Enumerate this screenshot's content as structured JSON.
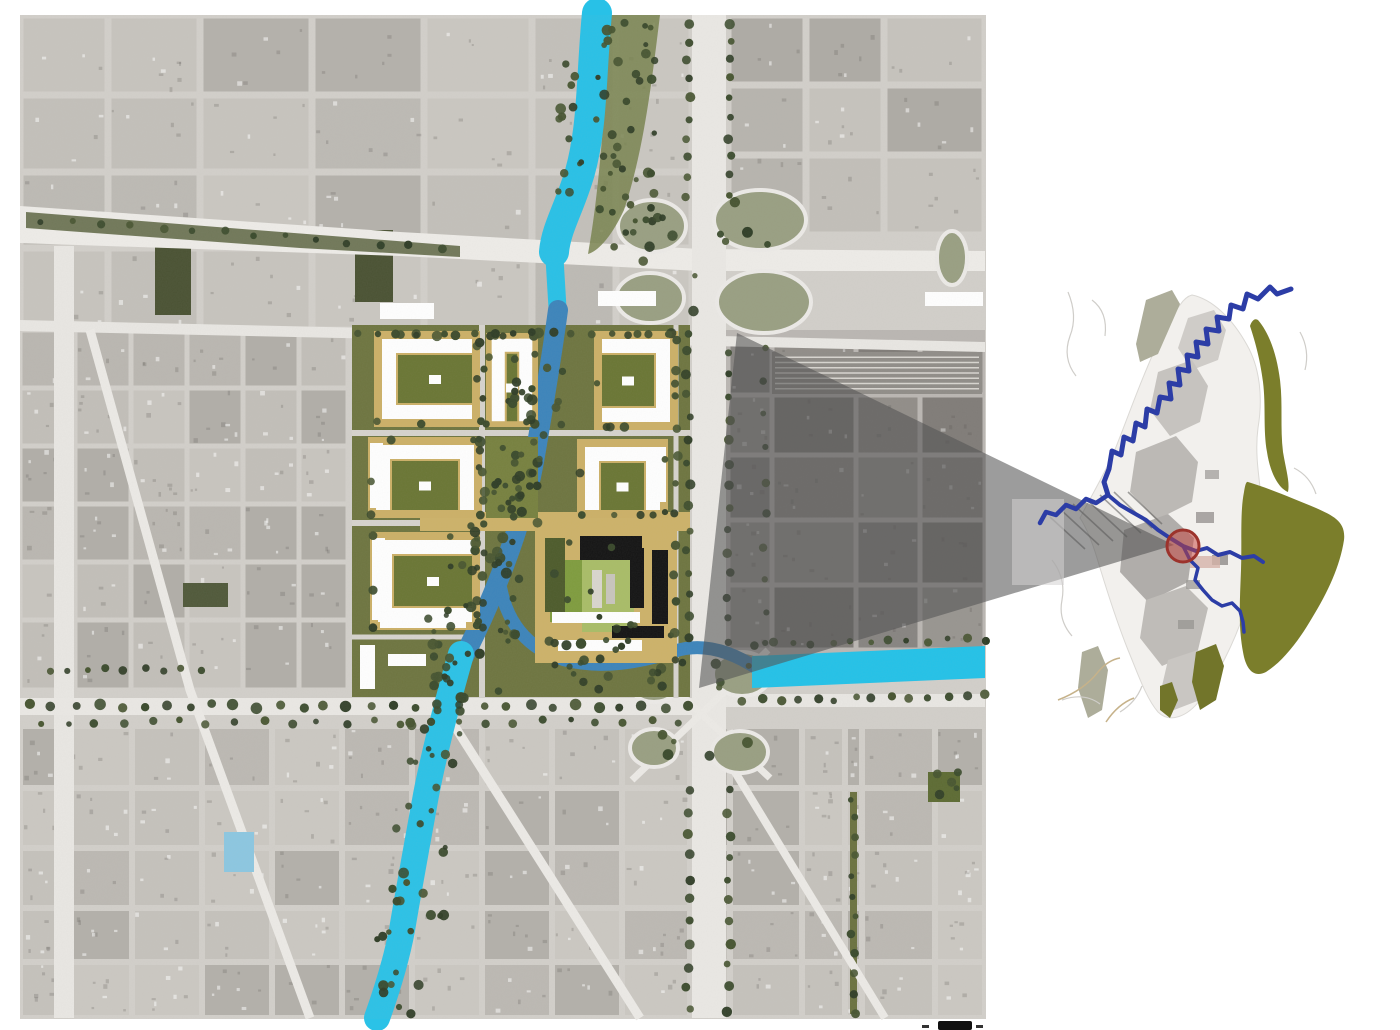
{
  "seed": 7,
  "palette": {
    "page_bg": "#ffffff",
    "aerial_base": "#d2cfca",
    "road": "#eceae6",
    "river_cyan": "#28c1e7",
    "river_steel": "#3c84bb",
    "plan_tan": "#ccb067",
    "plan_court_green": "#6a7634",
    "plan_olive": "#6e7540",
    "tree_greens": [
      "#2f3d26",
      "#3a4a2c",
      "#465430"
    ],
    "wedge_gray": "rgba(85,85,85,0.58)",
    "inset_land": "#f2f0ed",
    "inset_olive": "#7b7e2b",
    "inset_river_blue": "#2c3da6",
    "marker_red_fill": "rgba(197,64,58,0.5)",
    "marker_red_stroke": "#9c332c"
  },
  "main_map": {
    "frame": {
      "x": 20,
      "y": 15,
      "w": 966,
      "h": 1004,
      "fill": "#d2cfca"
    },
    "regions": [
      {
        "cols": [
          20,
          108,
          200,
          312,
          424,
          532,
          616,
          692
        ],
        "rows": [
          15,
          95,
          172,
          248,
          330
        ],
        "roadW": 7,
        "shades": [
          "#c7c4be",
          "#bdbab4",
          "#c3c0ba",
          "#b4b1ab",
          "#cac7c1"
        ],
        "speck": true
      },
      {
        "cols": [
          728,
          806,
          884,
          985
        ],
        "rows": [
          15,
          85,
          155,
          235
        ],
        "roadW": 7,
        "shades": [
          "#c2bfb9",
          "#b7b4ae",
          "#aeaba5",
          "#c6c3bd"
        ],
        "speck": true
      },
      {
        "cols": [
          728,
          772,
          856,
          920,
          985
        ],
        "rows": [
          340,
          395,
          455,
          520,
          585,
          650
        ],
        "roadW": 5,
        "shades": [
          "#a19e98",
          "#969390",
          "#8d8a85",
          "#aaa7a1"
        ],
        "speck": true
      },
      {
        "cols": [
          20,
          75,
          131,
          187,
          243,
          299,
          348
        ],
        "rows": [
          330,
          388,
          446,
          504,
          562,
          620,
          690
        ],
        "roadW": 5,
        "shades": [
          "#c2bfb9",
          "#bab7b1",
          "#b1aea8",
          "#c8c5bf"
        ],
        "speck": true
      },
      {
        "cols": [
          20,
          62,
          132,
          202,
          272,
          342,
          412,
          482,
          552,
          622,
          690,
          730,
          802,
          845,
          862,
          935,
          985
        ],
        "rows": [
          726,
          788,
          848,
          908,
          962,
          1018
        ],
        "roadW": 6,
        "shades": [
          "#c5c2bc",
          "#bcb9b3",
          "#b3b0aa",
          "#cbc8c2"
        ],
        "speck": true
      }
    ],
    "dark_blocks": [
      [
        155,
        245,
        36,
        70,
        "#4a5233"
      ],
      [
        355,
        230,
        38,
        72,
        "#4a5233"
      ],
      [
        183,
        583,
        45,
        24,
        "#50593a"
      ],
      [
        928,
        772,
        32,
        30,
        "#5d6b33"
      ]
    ],
    "rail": {
      "x": 772,
      "y": 352,
      "w": 210,
      "h": 42,
      "fill": "#908d88",
      "lines": 7,
      "lc": "#d8d5d0"
    },
    "shade": {
      "x": 698,
      "y": 330,
      "w": 287,
      "h": 330,
      "fill": "#3c3a37",
      "op": 0.16
    },
    "highways": [
      {
        "d": "M20,206 L400,232 L700,249 L985,251 L985,271 L700,271 L400,256 L20,243 Z",
        "fill": "#eeece8"
      },
      {
        "d": "M26,212 L460,246 L460,257 L300,248 L26,228 Z",
        "fill": "#5a6440",
        "op": 0.85
      },
      {
        "d": "M20,320 L985,342 L985,352 L20,331 Z",
        "fill": "#e9e7e3"
      },
      {
        "d": "M692,15 h34 v1003 h-34 Z",
        "fill": "#eae8e4"
      },
      {
        "d": "M54,246 h20 v772 h-20 Z",
        "fill": "#e9e7e3"
      },
      {
        "d": "M20,698 h672 v17 h-672 Z",
        "fill": "#eae8e4"
      },
      {
        "d": "M726,694 h259 v13 h-259 Z",
        "fill": "#e9e7e3"
      },
      {
        "d": "M850,792 h7 v222 h-7 Z",
        "fill": "#6b7240"
      }
    ],
    "road_strokes": {
      "color": "#eceae6",
      "items": [
        {
          "d": "M90,330 L190,690 L310,1018",
          "w": 9
        },
        {
          "d": "M438,700 L640,1018",
          "w": 9
        },
        {
          "d": "M735,772 L885,1018",
          "w": 8
        },
        {
          "d": "M635,652 L770,778",
          "w": 7
        },
        {
          "d": "M768,650 L632,780",
          "w": 7
        }
      ]
    },
    "loops": {
      "fill": "#999f82",
      "stroke": "#eceae7",
      "items": [
        [
          652,
          226,
          34,
          26
        ],
        [
          760,
          220,
          46,
          30
        ],
        [
          650,
          298,
          34,
          25
        ],
        [
          764,
          302,
          47,
          31
        ],
        [
          952,
          258,
          15,
          27
        ],
        [
          654,
          682,
          25,
          20
        ],
        [
          742,
          674,
          29,
          22
        ],
        [
          654,
          748,
          24,
          19
        ],
        [
          740,
          752,
          28,
          21
        ]
      ]
    },
    "bank": {
      "d": "M608,15 L660,15 C652,80 644,150 624,210 C610,240 596,252 588,254 C596,210 602,150 606,80 Z",
      "fill": "#78824e",
      "op": 0.85
    },
    "rivers": [
      {
        "d": "M597,13 C591,75 593,125 580,172 C570,207 556,228 554,252",
        "c": "#28c1e7",
        "w": 30
      },
      {
        "d": "M554,250 L558,316",
        "c": "#28c1e7",
        "w": 18
      },
      {
        "d": "M558,310 C551,362 544,402 536,450 C529,494 517,532 504,566 C494,592 480,626 463,658",
        "c": "#3c84bb",
        "w": 20
      },
      {
        "d": "M499,578 C505,625 530,650 565,660 C600,669 640,663 675,651 C707,641 737,655 758,669",
        "c": "#3c84bb",
        "w": 13
      },
      {
        "d": "M461,654 C448,700 435,748 426,795 C417,845 409,888 402,930 C396,962 387,990 377,1018",
        "c": "#2bc2e7",
        "w": 26
      }
    ],
    "canal": {
      "d": "M752,656 L985,646 L985,678 L752,688 Z",
      "fill": "#23c2e8"
    },
    "pond": {
      "x": 224,
      "y": 832,
      "w": 30,
      "h": 40,
      "fill": "#8cc7e1"
    },
    "plan": {
      "base": {
        "x": 352,
        "y": 325,
        "w": 338,
        "h": 372,
        "fill": "#6e7540"
      },
      "street_color": "#d6d3cd",
      "streets": [
        {
          "d": "M352,433 H690",
          "w": 6
        },
        {
          "d": "M352,523 H690",
          "w": 6
        },
        {
          "d": "M482,325 V697",
          "w": 6
        },
        {
          "d": "M676,325 V697",
          "w": 5
        },
        {
          "d": "M352,637 H480",
          "w": 5
        }
      ],
      "tan_band": {
        "d": "M420,512 H690 V531 H420 Z",
        "fill": "#cdb269"
      },
      "tan": "#ccb067",
      "court": "#6a7634",
      "white": "#ffffff",
      "blocks": [
        {
          "x": 374,
          "y": 331,
          "w": 106,
          "h": 96,
          "u": "E"
        },
        {
          "x": 486,
          "y": 333,
          "w": 52,
          "h": 94,
          "u": "S"
        },
        {
          "x": 594,
          "y": 331,
          "w": 84,
          "h": 99,
          "u": "W"
        },
        {
          "x": 368,
          "y": 437,
          "w": 114,
          "h": 81,
          "u": "S",
          "slabL": true
        },
        {
          "x": 486,
          "y": 437,
          "w": 52,
          "h": 81,
          "green": true
        },
        {
          "x": 577,
          "y": 439,
          "w": 91,
          "h": 79,
          "u": "S",
          "slabR": true
        },
        {
          "x": 370,
          "y": 532,
          "w": 110,
          "h": 98,
          "u": "E",
          "slabL": true,
          "slabB": true
        }
      ],
      "special": [
        [
          535,
          528,
          142,
          135,
          "#cdb269"
        ],
        [
          550,
          560,
          32,
          62,
          "#7f9c3e"
        ],
        [
          582,
          558,
          52,
          74,
          "#a9bd67"
        ],
        [
          545,
          538,
          20,
          74,
          "#4d5b2b"
        ],
        [
          580,
          536,
          62,
          24,
          "#141414"
        ],
        [
          630,
          548,
          14,
          60,
          "#141414"
        ],
        [
          652,
          550,
          16,
          74,
          "#141414"
        ],
        [
          612,
          626,
          52,
          12,
          "#141414"
        ],
        [
          552,
          612,
          88,
          11,
          "#ffffff"
        ],
        [
          592,
          570,
          10,
          38,
          "#d9d6ce"
        ],
        [
          606,
          574,
          9,
          30,
          "#c8c5bd"
        ],
        [
          558,
          640,
          84,
          11,
          "#ffffff"
        ]
      ],
      "slabs": [
        [
          380,
          303,
          54,
          16
        ],
        [
          598,
          291,
          58,
          15
        ],
        [
          925,
          292,
          58,
          14
        ],
        [
          360,
          645,
          15,
          44
        ],
        [
          388,
          654,
          38,
          12
        ]
      ]
    },
    "tree_rows": [
      [
        688,
        22,
        688,
        195,
        10,
        4
      ],
      [
        729,
        22,
        729,
        195,
        10,
        4
      ],
      [
        688,
        352,
        688,
        640,
        14,
        4
      ],
      [
        729,
        352,
        729,
        640,
        14,
        4
      ],
      [
        688,
        790,
        688,
        1010,
        11,
        4
      ],
      [
        729,
        790,
        729,
        1010,
        11,
        4
      ],
      [
        30,
        706,
        688,
        706,
        30,
        4.5
      ],
      [
        40,
        722,
        680,
        722,
        24,
        3.5
      ],
      [
        755,
        644,
        985,
        640,
        13,
        3.5
      ],
      [
        742,
        700,
        985,
        696,
        14,
        4
      ],
      [
        853,
        798,
        853,
        1012,
        12,
        3.5
      ],
      [
        50,
        670,
        200,
        670,
        9,
        3.5
      ],
      [
        360,
        334,
        688,
        334,
        18,
        4
      ],
      [
        482,
        345,
        482,
        628,
        12,
        4
      ],
      [
        676,
        340,
        676,
        660,
        12,
        4
      ],
      [
        765,
        350,
        765,
        645,
        10,
        3.5
      ],
      [
        40,
        220,
        440,
        248,
        14,
        3.5
      ]
    ],
    "tree_patches": [
      [
        596,
        20,
        60,
        230,
        44
      ],
      [
        558,
        30,
        24,
        215,
        13
      ],
      [
        505,
        332,
        60,
        96,
        20
      ],
      [
        480,
        430,
        64,
        100,
        22
      ],
      [
        450,
        525,
        70,
        108,
        24
      ],
      [
        418,
        605,
        100,
        88,
        26
      ],
      [
        540,
        640,
        140,
        52,
        22
      ],
      [
        404,
        690,
        62,
        118,
        16
      ],
      [
        392,
        808,
        54,
        118,
        14
      ],
      [
        376,
        928,
        48,
        86,
        11
      ],
      [
        618,
        196,
        180,
        140,
        12
      ],
      [
        628,
        660,
        150,
        108,
        10
      ],
      [
        928,
        772,
        32,
        30,
        5
      ]
    ],
    "icon": {
      "x": 938,
      "y": 1021,
      "w": 34,
      "h": 9,
      "fill": "#101010",
      "ticks": [
        [
          922,
          1025,
          7,
          3
        ],
        [
          976,
          1025,
          7,
          3
        ]
      ]
    }
  },
  "overlay": {
    "wedge": {
      "points": "737,333 1174,545 699,688",
      "fill": "rgba(85,85,85,0.58)"
    },
    "panel": {
      "x": 1012,
      "y": 499,
      "w": 52,
      "h": 86,
      "fill": "rgba(212,209,209,0.55)"
    }
  },
  "inset_map": {
    "land": {
      "d": "M1192,295 C1212,299 1232,318 1247,345 C1260,368 1263,398 1258,428 C1254,458 1261,486 1263,515 C1265,545 1255,578 1245,610 C1234,644 1217,676 1200,700 C1188,716 1170,724 1158,712 C1146,698 1138,674 1128,650 C1116,620 1106,588 1097,558 C1090,535 1084,524 1080,518 C1090,498 1103,477 1114,452 C1125,425 1135,396 1147,368 C1158,341 1170,318 1180,305 C1184,299 1188,296 1192,295 Z",
      "fill": "#f2f0ed",
      "stroke": "#dbd9d5"
    },
    "patches": [
      {
        "d": "M1188,318 l26,-8 l12,20 l-8,30 l-26,10 l-14,-22 Z",
        "fill": "#cfccc8"
      },
      {
        "d": "M1158,372 l34,-12 l16,26 l-8,36 l-30,14 l-20,-26 Z",
        "fill": "#c6c3bf"
      },
      {
        "d": "M1136,452 l40,-16 l22,26 l-6,40 l-36,18 l-26,-28 Z",
        "fill": "#bcb9b5"
      },
      {
        "d": "M1124,530 l44,-16 l26,24 l-6,44 l-40,20 l-28,-30 Z",
        "fill": "#b0adaa"
      },
      {
        "d": "M1146,600 l40,-14 l22,22 l-10,42 l-36,16 l-22,-28 Z",
        "fill": "#bfbcb8"
      },
      {
        "d": "M1168,660 l30,-10 l14,18 l-12,32 l-26,10 l-12,-24 Z",
        "fill": "#c9c6c2"
      }
    ],
    "dark_bits": [
      [
        1196,
        512,
        18,
        11,
        "#979491"
      ],
      [
        1212,
        555,
        16,
        10,
        "#8e8b88"
      ],
      [
        1186,
        580,
        14,
        9,
        "#a09d9a"
      ],
      [
        1205,
        470,
        14,
        9,
        "#a5a29f"
      ],
      [
        1178,
        620,
        16,
        9,
        "#9a9794"
      ],
      [
        1190,
        556,
        30,
        12,
        "#d4b3a9"
      ]
    ],
    "olive": [
      {
        "d": "M1258,320 C1270,334 1277,356 1280,380 C1283,404 1280,428 1283,452 C1286,470 1290,482 1288,492 C1278,488 1270,472 1267,452 C1263,430 1266,406 1263,382 C1260,358 1254,338 1250,326 C1252,320 1255,318 1258,320 Z",
        "fill": "#7b7e2b"
      },
      {
        "d": "M1248,482 C1268,488 1292,498 1316,508 C1334,516 1346,522 1344,540 C1340,566 1328,592 1312,618 C1298,642 1282,662 1266,672 C1254,678 1246,670 1243,652 C1238,626 1240,598 1241,570 C1242,540 1240,512 1244,492 C1245,486 1246,481 1248,482 Z",
        "fill": "#7b7e2b"
      },
      {
        "d": "M1196,652 l20,-8 l8,22 l-8,34 l-16,10 l-8,-28 Z",
        "fill": "#72752a"
      },
      {
        "d": "M1160,686 l12,-4 l6,18 l-8,18 l-10,-8 Z",
        "fill": "#72752a"
      }
    ],
    "strips": [
      {
        "d": "M1146,300 l26,-10 l8,14 l-22,50 l-18,8 l-4,-18 Z",
        "fill": "#adad9a"
      },
      {
        "d": "M1082,652 l16,-6 l10,24 l-6,40 l-14,8 l-10,-30 Z",
        "fill": "#adad9a"
      }
    ],
    "roads": {
      "color": "#cfcdc9",
      "items": [
        "M1068,292 q10,24 2,44 q-8,22 6,40",
        "M1092,300 q16,12 13,36",
        "M1052,560 q14,18 10,40 q-4,20 10,36",
        "M1062,700 q22,-8 38,4",
        "M1294,468 q16,8 22,26",
        "M1300,332 q10,18 5,38",
        "M1120,712 q16,-10 22,-26"
      ]
    },
    "creeks": {
      "color": "#c6b28a",
      "items": [
        "M1058,700 q26,-10 40,-28 q10,-12 22,-14",
        "M1106,722 q12,-18 28,-24"
      ]
    },
    "hatch": {
      "color": "#5d5c5a",
      "lines": [
        [
          1050,
          517,
          1085,
          549
        ],
        [
          1061,
          510,
          1099,
          545
        ],
        [
          1073,
          504,
          1113,
          541
        ],
        [
          1086,
          499,
          1127,
          537
        ],
        [
          1100,
          495,
          1141,
          533
        ],
        [
          1114,
          492,
          1152,
          528
        ],
        [
          1128,
          492,
          1162,
          524
        ]
      ]
    },
    "river": {
      "color": "#2c3da6",
      "paths": [
        {
          "d": "M1291,289 L1277,294 L1270,287 L1258,299 L1247,294 L1243,309 L1231,305 L1229,319 L1217,317 L1219,331 L1206,329 L1208,344 L1196,342 L1198,357 L1187,355 L1189,371 L1178,369 L1180,385 L1169,383 L1171,399 L1160,397 L1157,413 L1147,409 L1145,427 L1136,423 L1133,441 L1124,437 L1121,455 L1112,451 L1109,469 L1104,482 L1108,495",
          "w": 5
        },
        {
          "d": "M1108,495 L1096,503 L1086,499 L1076,509 L1066,505 L1056,515 L1046,512 L1040,523",
          "w": 4.5
        },
        {
          "d": "M1108,495 L1120,505 L1132,512 L1146,520 L1158,530 L1170,538 L1183,546 L1196,551 L1207,548 L1218,555 L1230,552 L1242,558 L1254,556 L1263,562",
          "w": 4
        },
        {
          "d": "M1183,546 L1190,560 L1198,568 L1195,580 L1203,590 L1212,600 L1222,606 L1232,603 L1240,611 L1243,622 L1244,632",
          "w": 3.5
        }
      ]
    },
    "marker": {
      "cx": 1183,
      "cy": 546,
      "r": 16,
      "fill": "rgba(197,64,58,0.5)",
      "stroke": "#9c332c",
      "sw": 3
    }
  }
}
